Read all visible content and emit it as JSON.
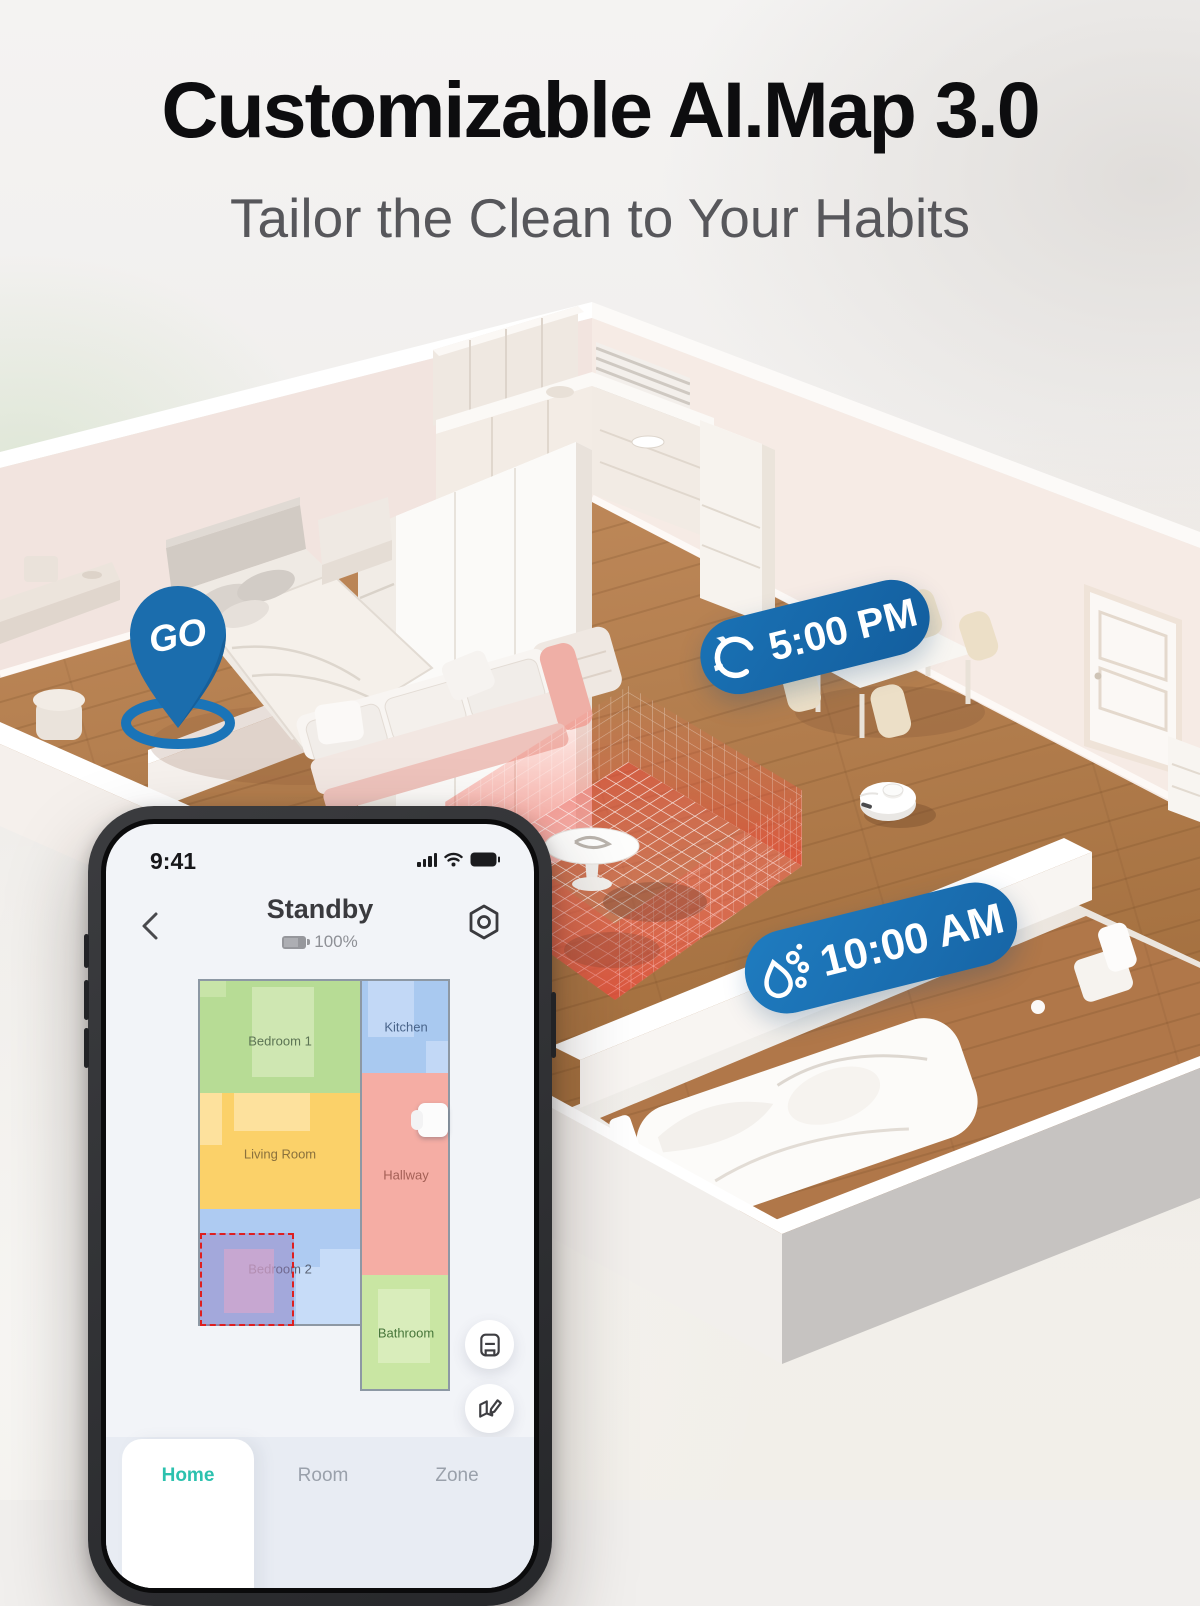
{
  "page": {
    "title": "Customizable AI.Map 3.0",
    "subtitle": "Tailor the Clean to Your Habits"
  },
  "scene": {
    "go_pin": {
      "label": "GO",
      "color": "#1b6dad"
    },
    "badges": [
      {
        "time": "5:00 PM",
        "icon": "vacuum-spin-icon",
        "color": "#1667a9"
      },
      {
        "time": "10:00 AM",
        "icon": "mop-water-drop-icon",
        "color": "#1c73b6"
      }
    ],
    "colors": {
      "floor_wood": "#b07a4c",
      "walls": "#f3e7e2",
      "no_go_zone_red": "#ef4437"
    }
  },
  "phone": {
    "status_bar": {
      "time": "9:41",
      "icons": [
        "signal-bars-icon",
        "wifi-icon",
        "battery-icon"
      ]
    },
    "header": {
      "title": "Standby",
      "battery_percent": "100%"
    },
    "map": {
      "rooms": [
        {
          "name": "Bedroom 1",
          "color": "#b7dc95",
          "label_color": "#5c7454"
        },
        {
          "name": "Kitchen",
          "color": "#a9c9f0",
          "label_color": "#49648a"
        },
        {
          "name": "Living Room",
          "color": "#fbd169",
          "label_color": "#8a713d"
        },
        {
          "name": "Hallway",
          "color": "#f5ada4",
          "label_color": "#a35f55"
        },
        {
          "name": "Bedroom 2",
          "color": "#aecbf2",
          "label_color": "#5a6375"
        },
        {
          "name": "Bathroom",
          "color": "#c9e6a3",
          "label_color": "#47763a"
        }
      ],
      "selection": {
        "room": "Bedroom 2",
        "style": "red-dashed-zone",
        "fill": "rgba(148,114,186,0.4)"
      },
      "dock": "robot-dock-icon"
    },
    "fabs": [
      {
        "name": "map-management-button",
        "icon": "map-manage-icon"
      },
      {
        "name": "edit-map-button",
        "icon": "map-edit-icon"
      }
    ],
    "tab_bar": {
      "active_color": "#2cc1ae",
      "tabs": [
        {
          "label": "Home",
          "active": true
        },
        {
          "label": "Room",
          "active": false
        },
        {
          "label": "Zone",
          "active": false
        }
      ]
    }
  }
}
